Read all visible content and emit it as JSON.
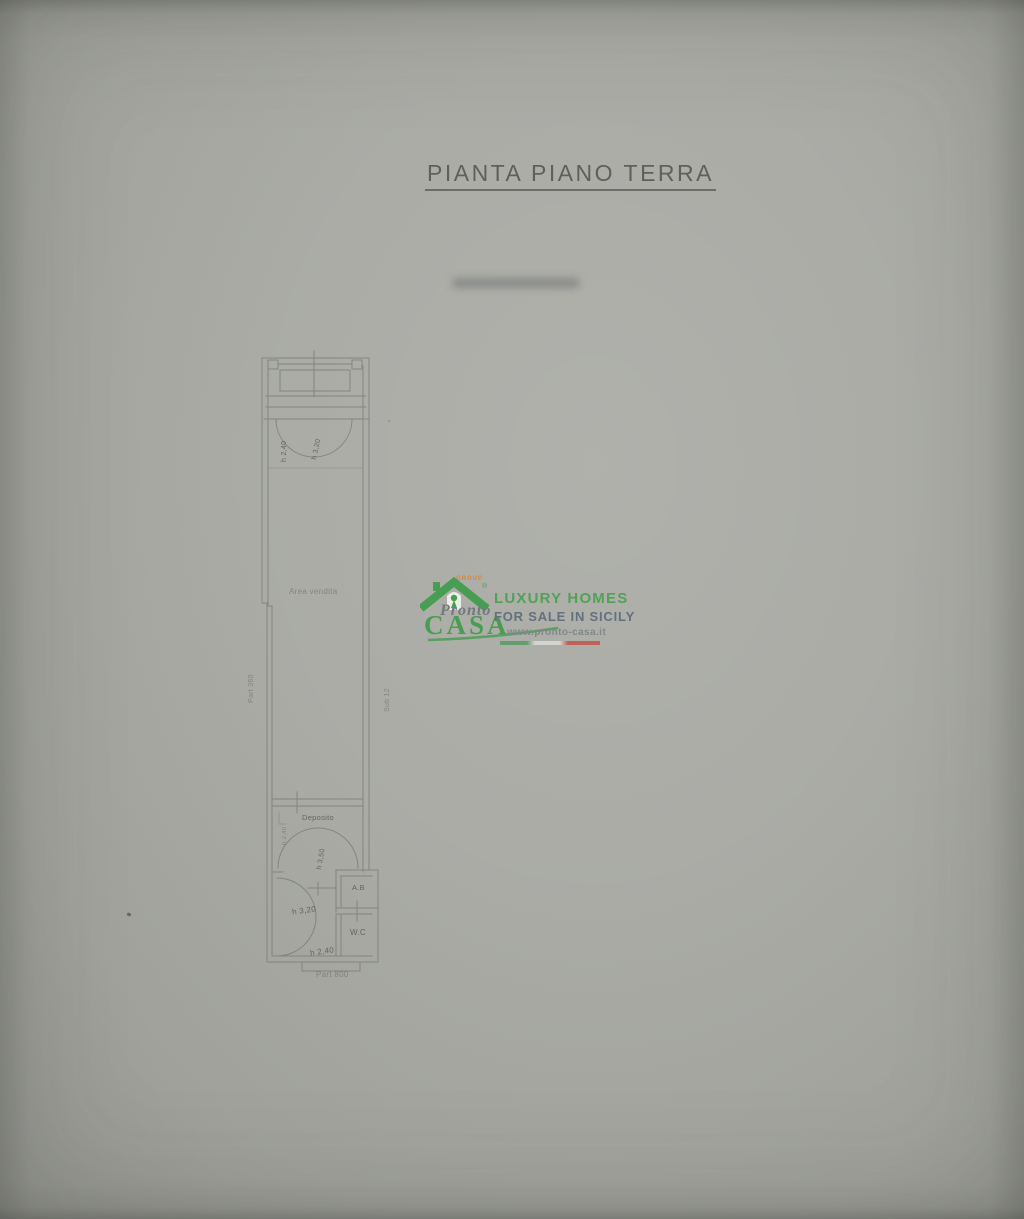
{
  "page": {
    "title": "PIANTA PIANO TERRA"
  },
  "plan": {
    "rooms": {
      "area_vendita": "Area vendita",
      "deposito": "Deposito",
      "ab": "A.B",
      "wc": "W.C"
    },
    "heights": {
      "entrance_left": "h 2,40",
      "entrance_arc": "h 3,20",
      "deposito_door": "h 2,40",
      "deposito_arc": "h 3,50",
      "bath": "h 3,20",
      "bath_bottom": "h 2,40"
    },
    "cadastral": {
      "left": "Part 360",
      "right": "Sub 12",
      "bottom": "Part 800"
    }
  },
  "watermark": {
    "group": "GROUP",
    "registered": "®",
    "brand_script": "Pronto",
    "brand_main": "CASA",
    "tagline1": "LUXURY HOMES",
    "tagline2": "FOR SALE IN SICILY",
    "website": "www.pronto-casa.it"
  },
  "colors": {
    "paper": "#a7a8a2",
    "plan_line": "#797c74",
    "brand_green": "#3f9c4b",
    "brand_slate": "#5d6b7b",
    "brand_gray": "#7d8489",
    "brand_orange": "#dd8030",
    "flag_red": "#c24b41"
  }
}
